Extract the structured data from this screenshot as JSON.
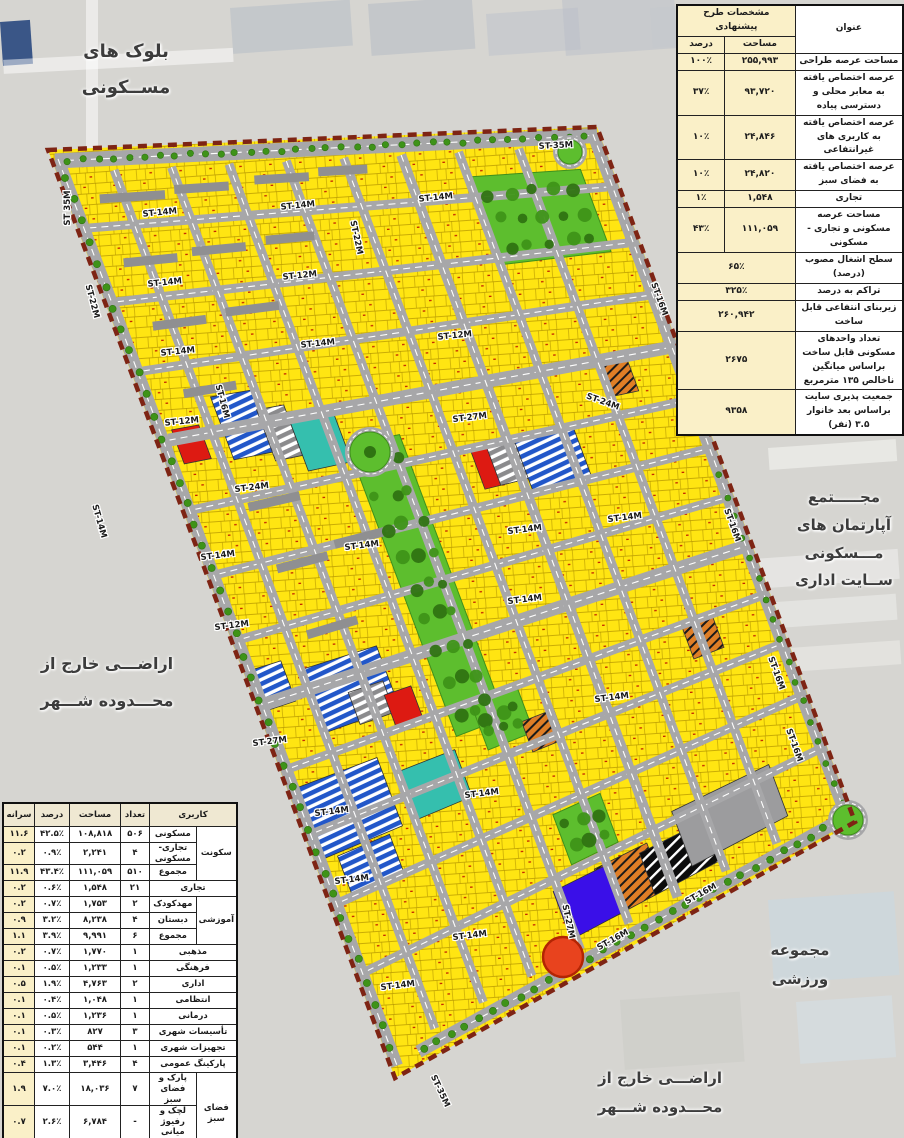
{
  "palette": {
    "bg": "#d6d5d1",
    "site": "#EAE7DF",
    "yellow": "#FFE512",
    "parcel_line": "#b99a00",
    "street": "#A7A7A9",
    "dash": "#ffffff",
    "park": "#5DBE2E",
    "tree": "#3E9318",
    "tree_dark": "#2F7312",
    "blue": "#2257C9",
    "teal": "#35BFAE",
    "red": "#DD1A12",
    "purple": "#3A0FE8",
    "orange": "#DF7E26",
    "grey_block": "#9C9C9E",
    "slab": "#8F8F91",
    "boundary": "#7E2414",
    "red_circle": "#E8431E",
    "label": "#3c3c3c"
  },
  "labels": {
    "residential_blocks": "بلوک های\nمســکونی",
    "boulevard": "بلــوار شــهر",
    "apartment_complex": "مجـــــتمع\nآپارتمان های\nمـــسکونی\nســایت اداری",
    "outside_left": "اراضـــی خارج از\nمحـــدوده شـــهر",
    "sports_complex": "مجموعه\nورزشی",
    "outside_bottom": "اراضـــی خارج از\nمحـــدوده شـــهر"
  },
  "spec_table": {
    "header_title": "مشخصات طرح پیشنهادی",
    "col_title": "عنوان",
    "col_area": "مساحت",
    "col_percent": "درصد",
    "rows": [
      {
        "title": "مساحت عرصه طراحی",
        "area": "۲۵۵,۹۹۳",
        "percent": "۱۰۰٪"
      },
      {
        "title": "عرصه اختصاص یافته به معابر محلی و دسترسی پیاده",
        "area": "۹۳,۷۲۰",
        "percent": "۳۷٪"
      },
      {
        "title": "عرصه اختصاص یافته به کاربری های غیرانتفاعی",
        "area": "۲۴,۸۴۶",
        "percent": "۱۰٪"
      },
      {
        "title": "عرصه اختصاص یافته به فضای سبز",
        "area": "۲۴,۸۲۰",
        "percent": "۱۰٪"
      },
      {
        "title": "تجاری",
        "area": "۱,۵۴۸",
        "percent": "۱٪"
      },
      {
        "title": "مساحت عرصه مسکونی و تجاری - مسکونی",
        "area": "۱۱۱,۰۵۹",
        "percent": "۴۳٪"
      },
      {
        "title": "سطح اشغال مصوب (درصد)",
        "value": "۶۵٪"
      },
      {
        "title": "تراکم به درصد",
        "value": "۳۲۵٪"
      },
      {
        "title": "زیربنای انتفاعی قابل ساخت",
        "value": "۲۶۰,۹۴۲"
      },
      {
        "title": "تعداد واحدهای مسکونی قابل ساخت براساس میانگین ناخالص ۱۳۵ مترمربع",
        "value": "۲۶۷۵"
      },
      {
        "title": "جمعیت پذیری سایت براساس بعد خانوار ۳.۵ (نفر)",
        "value": "۹۳۵۸"
      }
    ]
  },
  "landuse_table": {
    "col_use": "کاربری",
    "col_count": "تعداد",
    "col_area": "مساحت",
    "col_percent": "درصد",
    "col_capita": "سرانه",
    "rows": [
      {
        "group": "سکونت",
        "gspan": 3,
        "use": "مسکونی",
        "count": "۵۰۶",
        "area": "۱۰۸,۸۱۸",
        "percent": "۴۲.۵٪",
        "capita": "۱۱.۶"
      },
      {
        "use": "تجاری-مسکونی",
        "count": "۴",
        "area": "۲,۲۴۱",
        "percent": "۰.۹٪",
        "capita": "۰.۲"
      },
      {
        "use": "مجموع",
        "count": "۵۱۰",
        "area": "۱۱۱,۰۵۹",
        "percent": "۴۳.۴٪",
        "capita": "۱۱.۹"
      },
      {
        "use": "تجاری",
        "count": "۲۱",
        "area": "۱,۵۴۸",
        "percent": "۰.۶٪",
        "capita": "۰.۲",
        "wide": true
      },
      {
        "group": "آموزشی",
        "gspan": 3,
        "use": "مهدکودک",
        "count": "۲",
        "area": "۱,۷۵۳",
        "percent": "۰.۷٪",
        "capita": "۰.۲"
      },
      {
        "use": "دبستان",
        "count": "۴",
        "area": "۸,۲۳۸",
        "percent": "۳.۲٪",
        "capita": "۰.۹"
      },
      {
        "use": "مجموع",
        "count": "۶",
        "area": "۹,۹۹۱",
        "percent": "۳.۹٪",
        "capita": "۱.۱"
      },
      {
        "use": "مذهبی",
        "count": "۱",
        "area": "۱,۷۷۰",
        "percent": "۰.۷٪",
        "capita": "۰.۲",
        "wide": true
      },
      {
        "use": "فرهنگی",
        "count": "۱",
        "area": "۱,۲۳۳",
        "percent": "۰.۵٪",
        "capita": "۰.۱",
        "wide": true
      },
      {
        "use": "اداری",
        "count": "۲",
        "area": "۴,۷۶۳",
        "percent": "۱.۹٪",
        "capita": "۰.۵",
        "wide": true
      },
      {
        "use": "انتظامی",
        "count": "۱",
        "area": "۱,۰۴۸",
        "percent": "۰.۴٪",
        "capita": "۰.۱",
        "wide": true
      },
      {
        "use": "درمانی",
        "count": "۱",
        "area": "۱,۲۳۶",
        "percent": "۰.۵٪",
        "capita": "۰.۱",
        "wide": true
      },
      {
        "use": "تأسیسات شهری",
        "count": "۳",
        "area": "۸۲۷",
        "percent": "۰.۳٪",
        "capita": "۰.۱",
        "wide": true
      },
      {
        "use": "تجهیزات شهری",
        "count": "۱",
        "area": "۵۴۴",
        "percent": "۰.۲٪",
        "capita": "۰.۱",
        "wide": true
      },
      {
        "use": "پارکینگ عمومی",
        "count": "۴",
        "area": "۳,۴۴۶",
        "percent": "۱.۳٪",
        "capita": "۰.۴",
        "wide": true
      },
      {
        "group": "فضای سبز",
        "gspan": 3,
        "use": "پارک و فضای سبز",
        "count": "۷",
        "area": "۱۸,۰۳۶",
        "percent": "۷.۰٪",
        "capita": "۱.۹"
      },
      {
        "use": "لچک و رفیوژ میانی",
        "count": "-",
        "area": "۶,۷۸۴",
        "percent": "۲.۶٪",
        "capita": "۰.۷"
      },
      {
        "use": "مجموع",
        "count": "۷",
        "area": "۲۴,۸۲۰",
        "percent": "۹.۷٪",
        "capita": "۲.۷"
      },
      {
        "use": "معابر",
        "count": "",
        "area": "۹۳,۷۲۰",
        "percent": "۳۶.۶٪",
        "capita": "۱۰.۰",
        "wide": true
      },
      {
        "use": "مجموع",
        "count": "۵۵۸",
        "area": "۲۵۵,۹۹۳",
        "percent": "۱۰۰٪",
        "capita": "۲۷.۴",
        "wide": true
      }
    ]
  },
  "street_labels": [
    {
      "text": "ST 35M",
      "x": 70,
      "y": 208,
      "r": -90
    },
    {
      "text": "ST-35M",
      "x": 556,
      "y": 148,
      "r": -3
    },
    {
      "text": "ST-14M",
      "x": 160,
      "y": 215,
      "r": -6
    },
    {
      "text": "ST-14M",
      "x": 298,
      "y": 208,
      "r": -6
    },
    {
      "text": "ST-14M",
      "x": 436,
      "y": 200,
      "r": -6
    },
    {
      "text": "ST-12M",
      "x": 300,
      "y": 278,
      "r": -6
    },
    {
      "text": "ST-14M",
      "x": 165,
      "y": 285,
      "r": -6
    },
    {
      "text": "ST-14M",
      "x": 178,
      "y": 354,
      "r": -6
    },
    {
      "text": "ST-14M",
      "x": 318,
      "y": 346,
      "r": -6
    },
    {
      "text": "ST-12M",
      "x": 455,
      "y": 338,
      "r": -6
    },
    {
      "text": "ST-12M",
      "x": 182,
      "y": 424,
      "r": -6
    },
    {
      "text": "ST-27M",
      "x": 470,
      "y": 420,
      "r": -7
    },
    {
      "text": "ST-24M",
      "x": 252,
      "y": 490,
      "r": -7
    },
    {
      "text": "ST-24M",
      "x": 602,
      "y": 404,
      "r": 20
    },
    {
      "text": "ST-14M",
      "x": 218,
      "y": 558,
      "r": -7
    },
    {
      "text": "ST-14M",
      "x": 362,
      "y": 548,
      "r": -7
    },
    {
      "text": "ST-14M",
      "x": 525,
      "y": 532,
      "r": -7
    },
    {
      "text": "ST-14M",
      "x": 625,
      "y": 520,
      "r": -7
    },
    {
      "text": "ST-12M",
      "x": 232,
      "y": 628,
      "r": -7
    },
    {
      "text": "ST-14M",
      "x": 525,
      "y": 602,
      "r": -7
    },
    {
      "text": "ST-27M",
      "x": 270,
      "y": 744,
      "r": -7
    },
    {
      "text": "ST-14M",
      "x": 612,
      "y": 700,
      "r": -7
    },
    {
      "text": "ST-14M",
      "x": 332,
      "y": 814,
      "r": -7
    },
    {
      "text": "ST-14M",
      "x": 482,
      "y": 796,
      "r": -7
    },
    {
      "text": "ST-14M",
      "x": 352,
      "y": 882,
      "r": -7
    },
    {
      "text": "ST-14M",
      "x": 470,
      "y": 938,
      "r": -7
    },
    {
      "text": "ST-14M",
      "x": 398,
      "y": 988,
      "r": -7
    },
    {
      "text": "ST-22M",
      "x": 90,
      "y": 302,
      "r": 75
    },
    {
      "text": "ST-22M",
      "x": 354,
      "y": 238,
      "r": 78
    },
    {
      "text": "ST-16M",
      "x": 220,
      "y": 402,
      "r": 75
    },
    {
      "text": "ST-16M",
      "x": 657,
      "y": 300,
      "r": 70
    },
    {
      "text": "ST-16M",
      "x": 730,
      "y": 526,
      "r": 70
    },
    {
      "text": "ST-16M",
      "x": 774,
      "y": 674,
      "r": 70
    },
    {
      "text": "ST-14M",
      "x": 97,
      "y": 522,
      "r": 74
    },
    {
      "text": "ST-27M",
      "x": 566,
      "y": 922,
      "r": 78
    },
    {
      "text": "ST-16M",
      "x": 614,
      "y": 942,
      "r": -29
    },
    {
      "text": "ST-16M",
      "x": 702,
      "y": 896,
      "r": -29
    },
    {
      "text": "ST-35M",
      "x": 438,
      "y": 1092,
      "r": 65
    },
    {
      "text": "ST-16M",
      "x": 792,
      "y": 746,
      "r": 70
    }
  ]
}
